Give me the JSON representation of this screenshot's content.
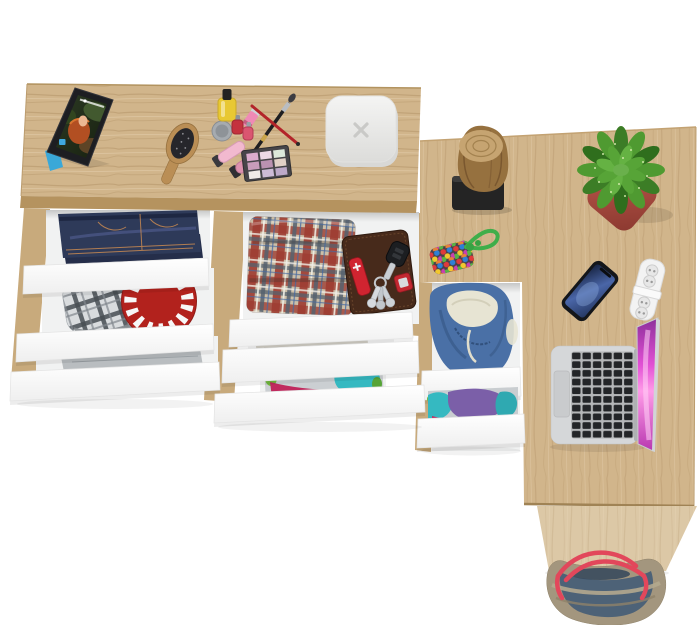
{
  "meta": {
    "title": "Top-down product photo of an L-shaped oak desk with drawer chest and open white drawers",
    "view": "top-down",
    "style": "studio render on white background"
  },
  "palette": {
    "background": "#ffffff",
    "oak": "#d1b58b",
    "oakEdge": "#b5935f",
    "oakSide": "#dcc8a6",
    "oakPost": "#c8aa7c",
    "interior": "#f1f2f2",
    "drawerFront": "#fdfdfd",
    "jeans": "#2e3a59",
    "stitch": "#c08552",
    "towelGray": "#b9bdc0",
    "towelBeige": "#d0cdc4",
    "redPlate": "#b2221d",
    "grayPlaidLight": "#d9dcde",
    "grayPlaidDark": "#484d54",
    "plaidTan": "#ccbfa8",
    "plaidRed": "#a03e32",
    "plaidSlate": "#56626e",
    "wallet": "#472a1b",
    "knifeRed": "#d02430",
    "hoodieBlue": "#4a70a6",
    "hoodieLining": "#e7e4d3",
    "clothPurple": "#7b5fa8",
    "clothTeal": "#35b9c1",
    "clothMagenta": "#c02a5e",
    "clothGreen": "#72b93e",
    "stump": "#96713f",
    "stumpTop": "#c6a471",
    "stand": "#242424",
    "pot": "#b25048",
    "leaf": "#4f9a31",
    "cord": "#3fae4a",
    "phone": "#14161a",
    "powerStrip": "#f3f3f3",
    "laptop": "#d5d7d9",
    "laptopKeys": "#232528",
    "screenPink": "#e14fd4",
    "bagBlue": "#4d6277",
    "bagRim": "#a3967e",
    "bagStrap": "#e2475b",
    "gadgetWhite": "#ededec",
    "tabletBezel": "#1d1e22",
    "standBlue": "#3aa8d8",
    "brushWood": "#ba8e55"
  },
  "inventory": [
    "oak L-shaped desk with drawer chest, all drawers open",
    "tablet propped on blue stand playing a movie",
    "wooden hairbrush",
    "cosmetics set: yellow nail polish, mini polishes, lipstick, silver jar, two gloss tubes, crossed brushes, eyeshadow palette",
    "white rounded-square gadget with x mark",
    "folded blue jeans in top-left drawer",
    "gray plaid flat cap in drawer",
    "red plate with white pattern in drawer",
    "folded gray sweater in drawer",
    "folded plaid blanket in middle drawer",
    "brown leather wallet with pocket knife, car key, keyring and red fob",
    "folded beige towel in drawer",
    "stack of colorful folded clothes in drawer",
    "wood log bookend on black stand",
    "green speckled succulent in terracotta pot",
    "multicolor beaded pouch with green cord",
    "smartphone lying on desk",
    "white power strip",
    "open silver laptop with pink wallpaper",
    "blue hooded jacket stuffed in desk drawer",
    "purple and teal folded clothes in desk drawer",
    "canvas tote bag with red straps under the desk"
  ]
}
